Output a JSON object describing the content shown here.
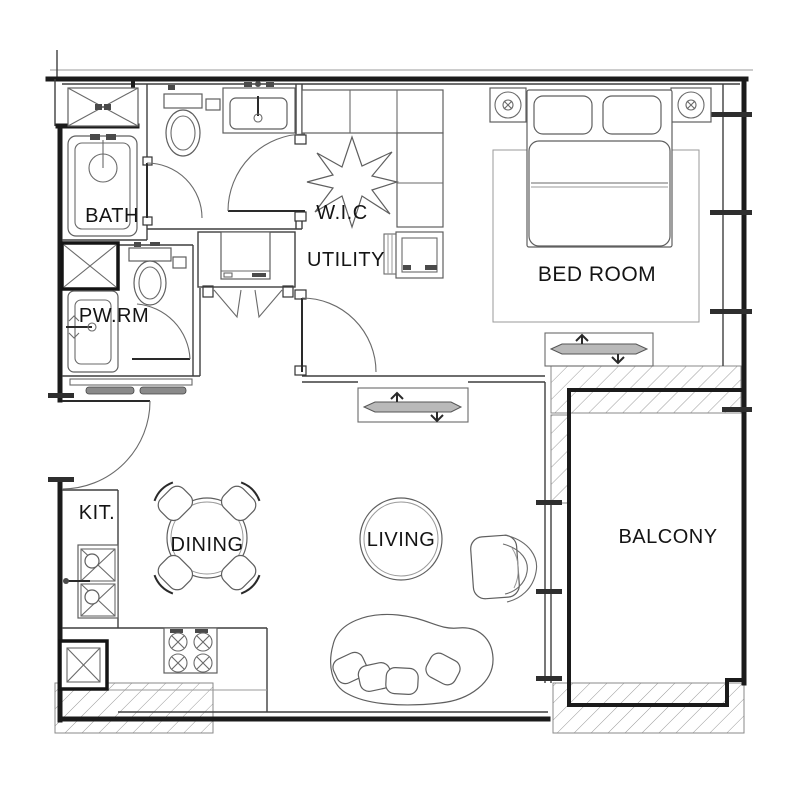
{
  "rooms": {
    "bath": {
      "label": "BATH"
    },
    "powder_room": {
      "label": "PW.RM"
    },
    "walk_in_closet": {
      "label": "W.I.C"
    },
    "utility": {
      "label": "UTILITY"
    },
    "bedroom": {
      "label": "BED ROOM"
    },
    "kitchen": {
      "label": "KIT."
    },
    "dining": {
      "label": "DINING"
    },
    "living": {
      "label": "LIVING"
    },
    "balcony": {
      "label": "BALCONY"
    }
  },
  "colors": {
    "wall": "#1b1b1b",
    "interior_line": "#3f3f3f",
    "furniture_line": "#5f5f5f",
    "hatch_line": "#9b9b9b",
    "label_text": "#141414",
    "background": "#ffffff"
  }
}
